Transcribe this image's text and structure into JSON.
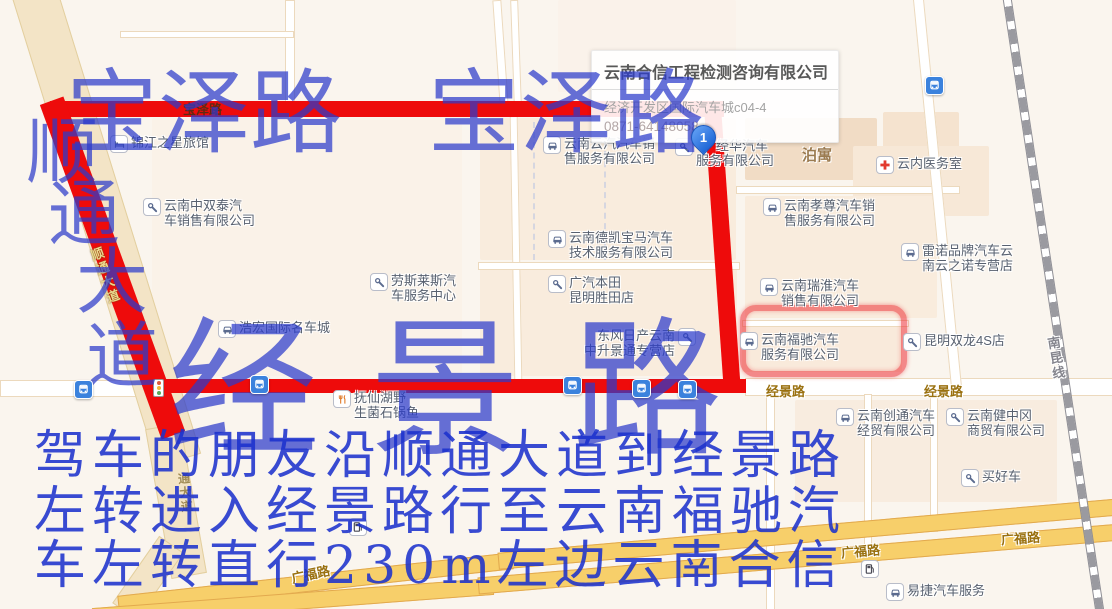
{
  "info_box": {
    "title": "云南合信工程检测咨询有限公司",
    "address": "经济开发区国际汽车城c04-4",
    "phone": "0871-64148058"
  },
  "marker": {
    "label": "1"
  },
  "watermarks": {
    "baoze_left": {
      "text": "宝泽路",
      "x": 66,
      "y": 68,
      "size": 92
    },
    "baoze_right": {
      "text": "宝泽路",
      "x": 428,
      "y": 68,
      "size": 92
    },
    "shuntong_chars": [
      {
        "text": "顺",
        "x": 26,
        "y": 116
      },
      {
        "text": "通",
        "x": 48,
        "y": 178
      },
      {
        "text": "大",
        "x": 76,
        "y": 246
      },
      {
        "text": "道",
        "x": 86,
        "y": 320
      }
    ],
    "shuntong_size": 72,
    "jingjing": {
      "text": "经景路",
      "x": 168,
      "y": 316,
      "size": 150,
      "spacing": 52
    }
  },
  "directions": [
    {
      "text": "驾车的朋友沿顺通大道到经景路",
      "x": 34,
      "y": 430
    },
    {
      "text": "左转进入经景路行至云南福驰汽",
      "x": 34,
      "y": 486
    },
    {
      "text": "车左转直行230m左边云南合信",
      "x": 34,
      "y": 540
    }
  ],
  "pois": [
    {
      "type": "bed",
      "lines": [
        "锦江之星旅馆"
      ],
      "x": 110,
      "y": 135
    },
    {
      "type": "wrench",
      "lines": [
        "云南中双泰汽",
        "车销售有限公司"
      ],
      "x": 143,
      "y": 198
    },
    {
      "type": "car",
      "lines": [
        "云南云汽汽车销",
        "售服务有限公司"
      ],
      "x": 543,
      "y": 136
    },
    {
      "type": "wrench",
      "lines": [
        "经华汽车",
        "服务有限公司"
      ],
      "x": 675,
      "y": 138,
      "pad1": 20
    },
    {
      "type": "cross",
      "lines": [
        "云内医务室"
      ],
      "x": 876,
      "y": 156
    },
    {
      "type": "car",
      "lines": [
        "云南孝尊汽车销",
        "售服务有限公司"
      ],
      "x": 763,
      "y": 198
    },
    {
      "type": "car",
      "lines": [
        "云南德凯宝马汽车",
        "技术服务有限公司"
      ],
      "x": 548,
      "y": 230
    },
    {
      "type": "car",
      "lines": [
        "雷诺品牌汽车云",
        "南云之诺专营店"
      ],
      "x": 901,
      "y": 243
    },
    {
      "type": "wrench",
      "lines": [
        "劳斯莱斯汽",
        "车服务中心"
      ],
      "x": 370,
      "y": 273
    },
    {
      "type": "wrench",
      "lines": [
        "广汽本田",
        "昆明胜田店"
      ],
      "x": 548,
      "y": 275
    },
    {
      "type": "car",
      "lines": [
        "云南瑞淮汽车",
        "销售有限公司"
      ],
      "x": 760,
      "y": 278
    },
    {
      "type": "car",
      "lines": [
        "浩宏国际名车城"
      ],
      "x": 218,
      "y": 320
    },
    {
      "type": "wrench",
      "lines": [
        "东风日产云南",
        "中升景通专营店"
      ],
      "x": 680,
      "y": 328,
      "side": "left"
    },
    {
      "type": "car",
      "lines": [
        "云南福驰汽车",
        "服务有限公司"
      ],
      "x": 740,
      "y": 332
    },
    {
      "type": "wrench",
      "lines": [
        "昆明双龙4S店"
      ],
      "x": 903,
      "y": 333
    },
    {
      "type": "rest",
      "lines": [
        "抚仙湖野",
        "生菌石锅鱼"
      ],
      "x": 333,
      "y": 390
    },
    {
      "type": "car",
      "lines": [
        "云南创通汽车",
        "经贸有限公司"
      ],
      "x": 836,
      "y": 408
    },
    {
      "type": "wrench",
      "lines": [
        "云南健中冈",
        "商贸有限公司"
      ],
      "x": 946,
      "y": 408
    },
    {
      "type": "wrench",
      "lines": [
        "买好车"
      ],
      "x": 961,
      "y": 469
    },
    {
      "type": "car",
      "lines": [
        "易捷汽车服务"
      ],
      "x": 886,
      "y": 583
    }
  ],
  "road_labels": [
    {
      "text": "宝泽路",
      "x": 183,
      "y": 99,
      "cls": "on-red"
    },
    {
      "text": "顺通大道",
      "x": 95,
      "y": 246,
      "cls": "on-red-v vert",
      "rot": -20
    },
    {
      "text": "通大道",
      "x": 177,
      "y": 472,
      "cls": "on-beige vert",
      "rot": -6
    },
    {
      "text": "经景路",
      "x": 766,
      "y": 381
    },
    {
      "text": "经景路",
      "x": 924,
      "y": 381
    },
    {
      "text": "广福路",
      "x": 291,
      "y": 564,
      "rot": -12
    },
    {
      "text": "广福路",
      "x": 841,
      "y": 541,
      "rot": -5
    },
    {
      "text": "广福路",
      "x": 1001,
      "y": 528,
      "rot": -4
    },
    {
      "text": "南昆线",
      "x": 1046,
      "y": 336,
      "cls": "rail-l vert",
      "rot": -9
    }
  ],
  "area_labels": [
    {
      "text": "泊寓",
      "x": 802,
      "y": 144
    }
  ],
  "bus_stops": [
    {
      "x": 74,
      "y": 380
    },
    {
      "x": 250,
      "y": 375
    },
    {
      "x": 563,
      "y": 376
    },
    {
      "x": 632,
      "y": 379
    },
    {
      "x": 678,
      "y": 380
    },
    {
      "x": 925,
      "y": 76
    }
  ],
  "gas_stations": [
    {
      "x": 349,
      "y": 518
    },
    {
      "x": 861,
      "y": 560
    }
  ],
  "traffic_lights": [
    {
      "x": 153,
      "y": 379
    }
  ],
  "colors": {
    "route_red": "#ee0b0b",
    "watermark_blue": "#2b3acb",
    "directions_blue": "#1a30cd",
    "marker_blue": "#2e7ce0",
    "highlight_ring": "#ec1c24",
    "map_background": "#faf5ee"
  }
}
